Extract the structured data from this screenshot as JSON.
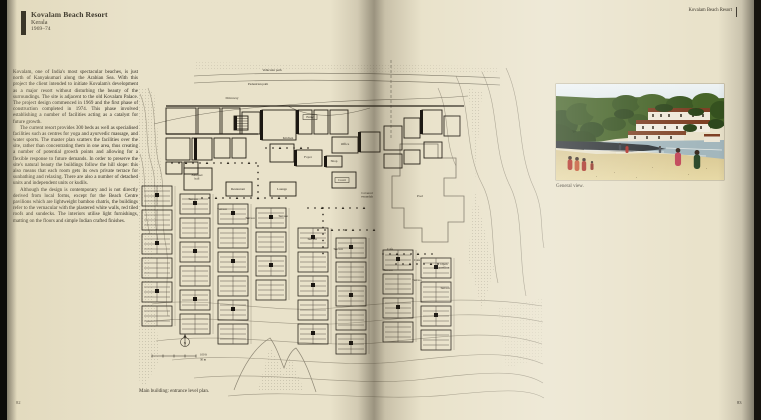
{
  "colors": {
    "paper": "#e9e2ca",
    "ink": "#2e2a21",
    "plan_line": "#6e685a",
    "photo_sand": "#e0d09c",
    "photo_palms": "#42602a",
    "photo_roof": "#7e4025",
    "sari_red": "#b23227"
  },
  "page": {
    "left_number": "82",
    "right_number": "83",
    "running_header": "Kovalam Beach Resort"
  },
  "project": {
    "title": "Kovalam Beach Resort",
    "location": "Kerala",
    "years": "1969–74"
  },
  "article": {
    "paragraphs": [
      "Kovalam, one of India's most spectacular beaches, is just north of Kanyakumari along the Arabian Sea. With this project the client intended to initiate Kovalam's development as a major resort without disturbing the beauty of the surroundings. The site is adjacent to the old Kovalam Palace. The project design commenced in 1969 and the first phase of construction completed in 1974. This phase involved establishing a number of facilities acting as a catalyst for future growth.",
      "The current resort provides 300 beds as well as specialised facilities such as centres for yoga and ayurvedic massage, and water sports. The master plan scatters the facilities over the site, rather than concentrating them in one area, thus creating a number of potential growth points and allowing for a flexible response to future demands. In order to preserve the site's natural beauty the buildings follow the hill slope: this also means that each room gets its own private terrace for sunbathing and relaxing. There are also a number of detached units and independent units or kudils.",
      "Although the design is contemporary and is not directly derived from local forms, except for the Beach Centre pavilions which are lightweight bamboo chatris, the buildings refer to the vernacular with the plastered white walls, red tiled roofs and sundecks. The interiors utilise light furnishings, matting on the floors and simple Indian crafted finishes."
    ]
  },
  "plan": {
    "caption": "Main building: entrance level plan.",
    "north_label": "N",
    "scale_imperial": "100 ft",
    "scale_metric": "30 m",
    "labels": [
      {
        "text": "Vehicular path",
        "x": 134,
        "y": 13
      },
      {
        "text": "Pedestrian path",
        "x": 120,
        "y": 27
      },
      {
        "text": "Driveway",
        "x": 94,
        "y": 41
      },
      {
        "text": "Entry",
        "x": 172,
        "y": 60,
        "boxed": true
      },
      {
        "text": "Kitchen",
        "x": 150,
        "y": 81
      },
      {
        "text": "Office",
        "x": 207,
        "y": 87
      },
      {
        "text": "Foyer",
        "x": 170,
        "y": 100
      },
      {
        "text": "Shop",
        "x": 196,
        "y": 104
      },
      {
        "text": "Court",
        "x": 204,
        "y": 123,
        "boxed": true
      },
      {
        "lines": [
          "Banquet",
          "hall"
        ],
        "x": 59,
        "y": 118
      },
      {
        "text": "Restaurant",
        "x": 100,
        "y": 132
      },
      {
        "text": "Lounge",
        "x": 144,
        "y": 132
      },
      {
        "lines": [
          "Covered",
          "verandah"
        ],
        "x": 229,
        "y": 136
      },
      {
        "text": "Pool",
        "x": 282,
        "y": 139
      },
      {
        "text": "Bar",
        "x": 207,
        "y": 173
      },
      {
        "text": "Terrace",
        "x": 55,
        "y": 142
      },
      {
        "text": "Terrace",
        "x": 84,
        "y": 152
      },
      {
        "text": "Terrace",
        "x": 112,
        "y": 161
      },
      {
        "text": "Terrace",
        "x": 145,
        "y": 159
      },
      {
        "text": "Terrace",
        "x": 174,
        "y": 182
      },
      {
        "text": "Terrace",
        "x": 200,
        "y": 192
      },
      {
        "text": "Cafe",
        "x": 252,
        "y": 192
      },
      {
        "text": "Cafe",
        "x": 279,
        "y": 203
      },
      {
        "text": "Terrace",
        "x": 250,
        "y": 213
      },
      {
        "text": "Terrace",
        "x": 279,
        "y": 223
      },
      {
        "lines": [
          "Open",
          "pavilion"
        ],
        "x": 306,
        "y": 207
      },
      {
        "text": "Terrace",
        "x": 307,
        "y": 231
      }
    ]
  },
  "photo": {
    "caption": "General view."
  }
}
